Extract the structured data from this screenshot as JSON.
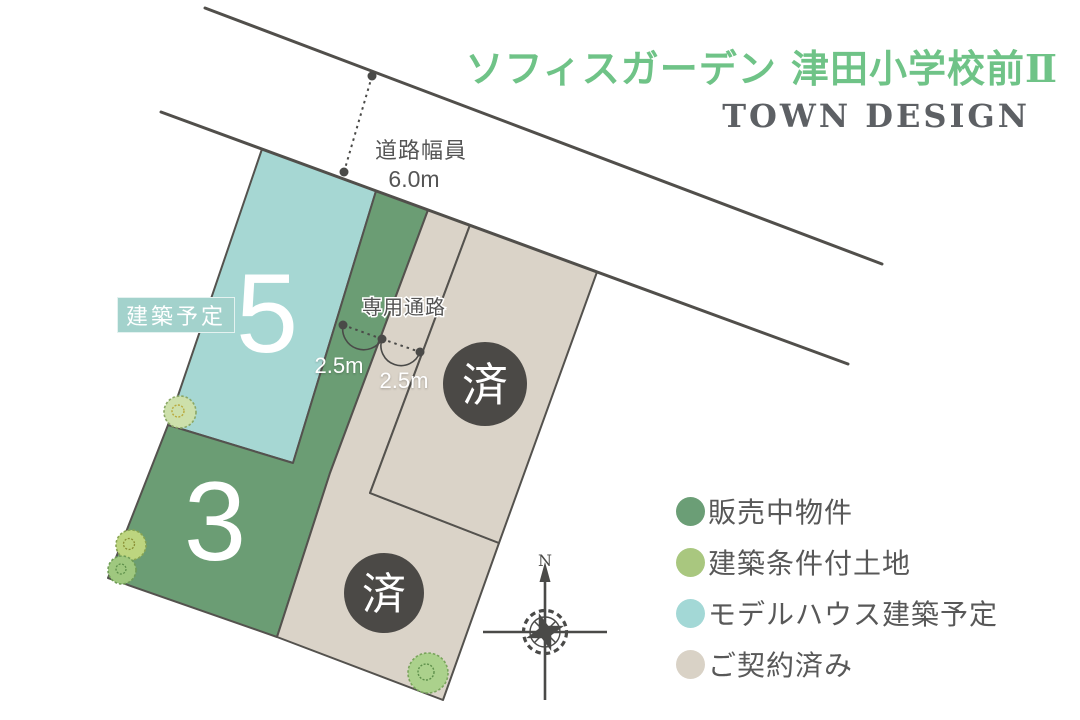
{
  "header": {
    "title": "ソフィスガーデン 津田小学校前Ⅱ",
    "subtitle": "TOWN DESIGN"
  },
  "road": {
    "width_label": "道路幅員",
    "width_value": "6.0m"
  },
  "passage": {
    "label": "専用通路",
    "width_1": "2.5m",
    "width_2": "2.5m"
  },
  "lots": {
    "lot5_number": "5",
    "lot5_badge": "建築予定",
    "lot3_number": "3",
    "sold_mark": "済"
  },
  "compass": {
    "north_label": "N"
  },
  "legend": {
    "items": [
      {
        "label": "販売中物件",
        "color": "#6b9e76"
      },
      {
        "label": "建築条件付土地",
        "color": "#a9c77f"
      },
      {
        "label": "モデルハウス建築予定",
        "color": "#a3d8d6"
      },
      {
        "label": "ご契約済み",
        "color": "#d9d2c6"
      }
    ]
  },
  "colors": {
    "title_green": "#6fc387",
    "subtitle_gray": "#5d6064",
    "lot_teal": "#a6d7d3",
    "lot_green": "#6b9d74",
    "lot_beige": "#dad3c8",
    "badge_teal": "#a3d2cc",
    "sold_circle": "#4b4946",
    "line_dark": "#514f4b"
  }
}
